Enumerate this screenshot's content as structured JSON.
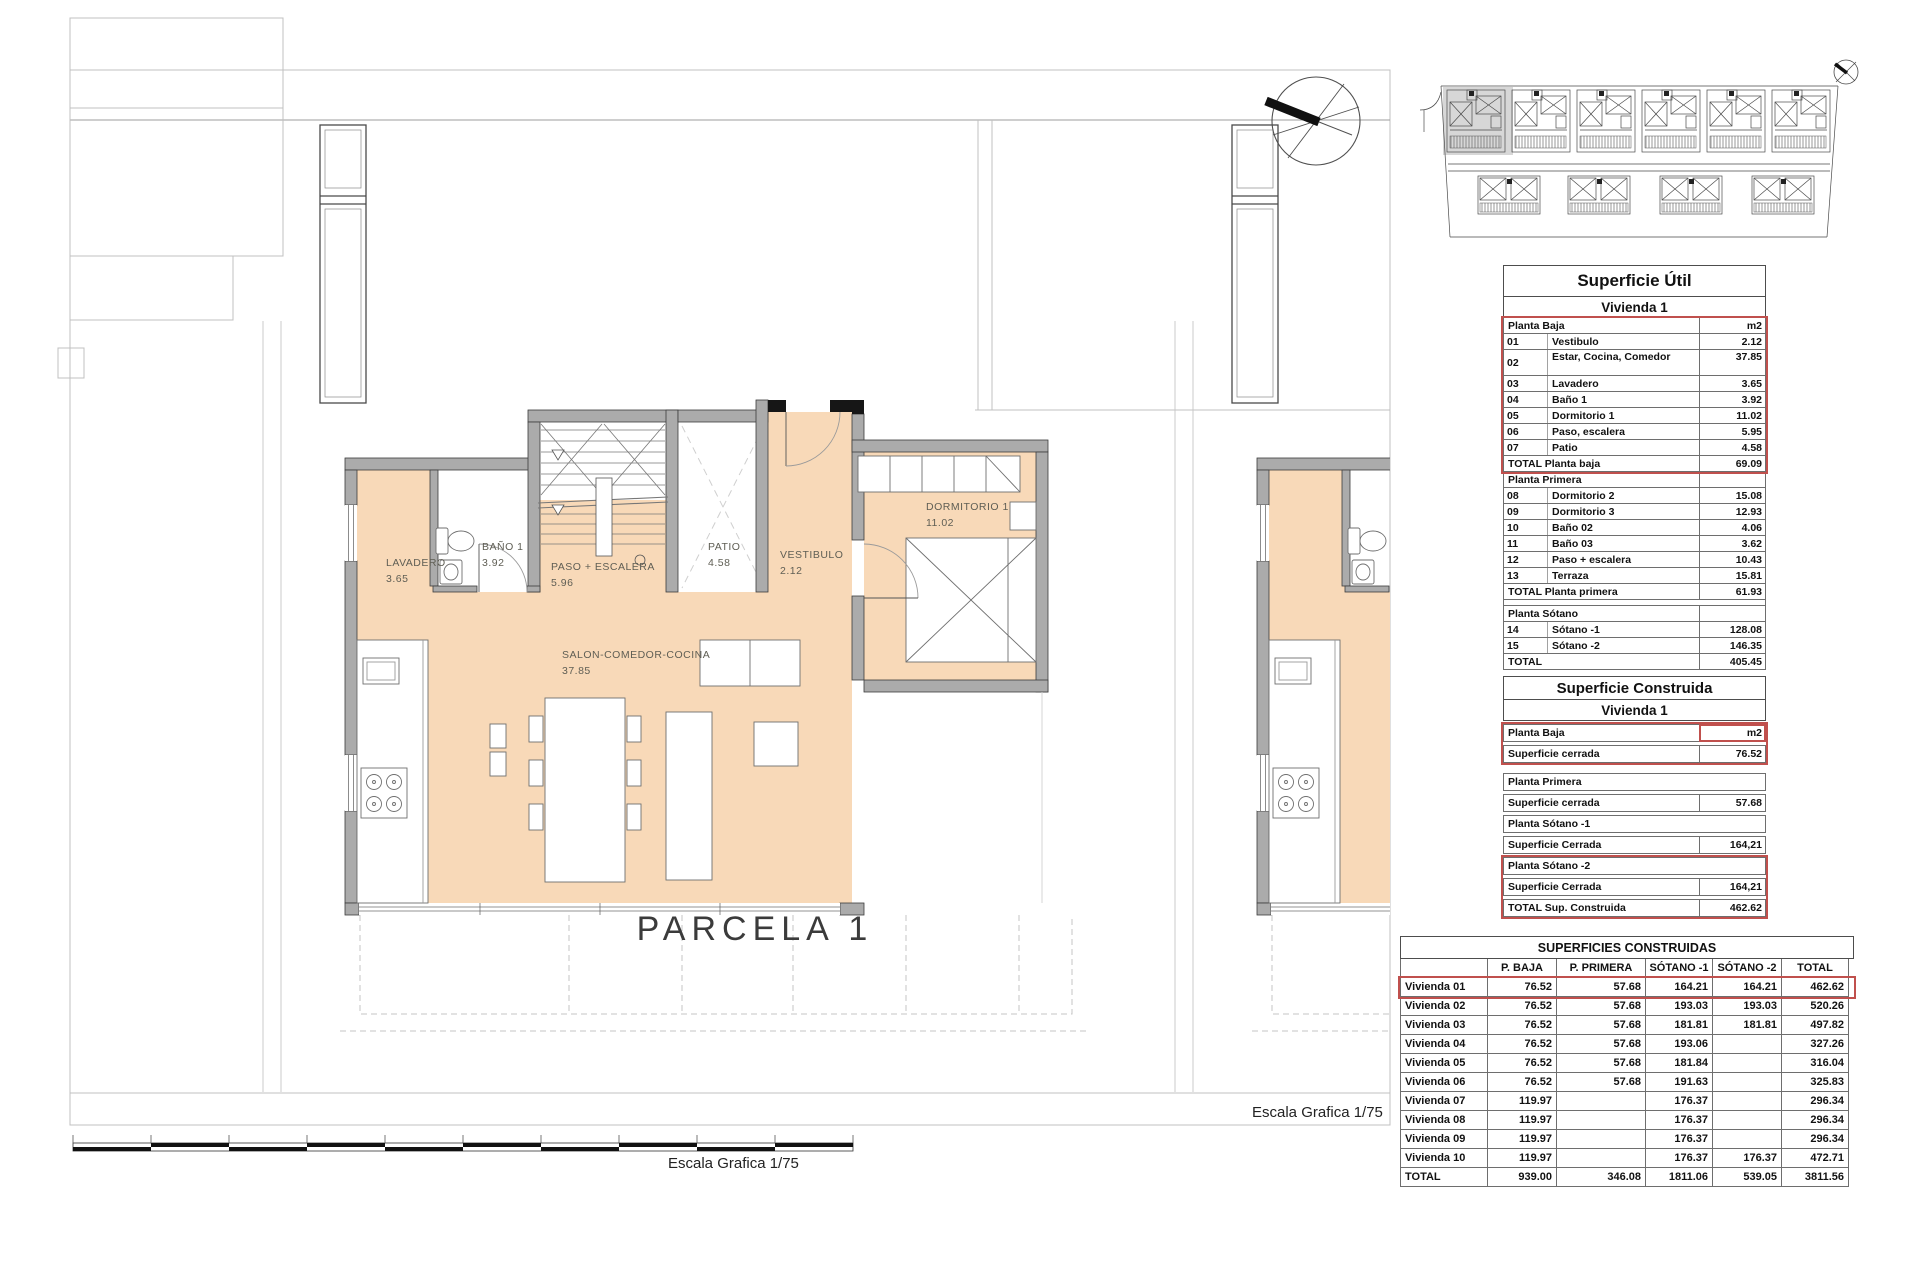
{
  "plan": {
    "parcel_label": "PARCELA 1",
    "scale_label_bottom": "Escala Grafica 1/75",
    "scale_label_right": "Escala Grafica 1/75",
    "rooms": [
      {
        "name": "LAVADERO",
        "area": "3.65"
      },
      {
        "name": "BAÑO 1",
        "area": "3.92"
      },
      {
        "name": "PASO + ESCALERA",
        "area": "5.96"
      },
      {
        "name": "PATIO",
        "area": "4.58"
      },
      {
        "name": "VESTIBULO",
        "area": "2.12"
      },
      {
        "name": "DORMITORIO 1",
        "area": "11.02"
      },
      {
        "name": "SALON-COMEDOR-COCINA",
        "area": "37.85"
      }
    ]
  },
  "colors": {
    "room_fill": "#f8d9b8",
    "wall_fill": "#ababab",
    "red_accent": "#c0504d",
    "context_line": "#c0c0c0"
  },
  "tables": {
    "superficie_util": {
      "title": "Superficie Útil",
      "subtitle": "Vivienda 1",
      "rows": [
        {
          "type": "section",
          "label": "Planta Baja",
          "value": "m2",
          "red": "start"
        },
        {
          "type": "item",
          "num": "01",
          "label": "Vestibulo",
          "value": "2.12",
          "red": "mid"
        },
        {
          "type": "item",
          "num": "02",
          "label": "Estar, Cocina, Comedor",
          "value": "37.85",
          "red": "mid",
          "tall": true
        },
        {
          "type": "item",
          "num": "03",
          "label": "Lavadero",
          "value": "3.65",
          "red": "mid"
        },
        {
          "type": "item",
          "num": "04",
          "label": "Baño 1",
          "value": "3.92",
          "red": "mid"
        },
        {
          "type": "item",
          "num": "05",
          "label": "Dormitorio 1",
          "value": "11.02",
          "red": "mid"
        },
        {
          "type": "item",
          "num": "06",
          "label": "Paso, escalera",
          "value": "5.95",
          "red": "mid"
        },
        {
          "type": "item",
          "num": "07",
          "label": "Patio",
          "value": "4.58",
          "red": "mid"
        },
        {
          "type": "total",
          "label": "TOTAL Planta baja",
          "value": "69.09",
          "red": "end"
        },
        {
          "type": "section",
          "label": "Planta Primera",
          "value": ""
        },
        {
          "type": "item",
          "num": "08",
          "label": "Dormitorio 2",
          "value": "15.08"
        },
        {
          "type": "item",
          "num": "09",
          "label": "Dormitorio 3",
          "value": "12.93"
        },
        {
          "type": "item",
          "num": "10",
          "label": "Baño 02",
          "value": "4.06"
        },
        {
          "type": "item",
          "num": "11",
          "label": "Baño 03",
          "value": "3.62"
        },
        {
          "type": "item",
          "num": "12",
          "label": "Paso + escalera",
          "value": "10.43"
        },
        {
          "type": "item",
          "num": "13",
          "label": "Terraza",
          "value": "15.81"
        },
        {
          "type": "total",
          "label": "TOTAL Planta primera",
          "value": "61.93"
        },
        {
          "type": "spacer",
          "label": "",
          "value": ""
        },
        {
          "type": "section",
          "label": "Planta Sótano",
          "value": ""
        },
        {
          "type": "item",
          "num": "14",
          "label": "Sótano -1",
          "value": "128.08"
        },
        {
          "type": "item",
          "num": "15",
          "label": "Sótano -2",
          "value": "146.35"
        },
        {
          "type": "total",
          "label": "TOTAL",
          "value": "405.45"
        }
      ]
    },
    "superficie_construida": {
      "title": "Superficie Construida",
      "subtitle": "Vivienda 1",
      "rows": [
        {
          "style": "section",
          "label": "Planta Baja",
          "value": "m2",
          "red": "start",
          "red_value": true
        },
        {
          "style": "value",
          "label": "Superficie cerrada",
          "value": "76.52",
          "red": "end"
        },
        {
          "style": "section",
          "label": "Planta Primera",
          "value": "",
          "gap": true
        },
        {
          "style": "value",
          "label": "Superficie cerrada",
          "value": "57.68"
        },
        {
          "style": "section",
          "label": "Planta Sótano -1",
          "value": ""
        },
        {
          "style": "value",
          "label": "Superficie Cerrada",
          "value": "164,21"
        },
        {
          "style": "section",
          "label": "Planta Sótano -2",
          "value": "",
          "red": "start"
        },
        {
          "style": "value",
          "label": "Superficie Cerrada",
          "value": "164,21",
          "red": "mid"
        },
        {
          "style": "total",
          "label": "TOTAL Sup. Construida",
          "value": "462.62",
          "red": "end"
        }
      ]
    },
    "superficies_construidas": {
      "title": "SUPERFICIES CONSTRUIDAS",
      "columns": [
        "",
        "P. BAJA",
        "P. PRIMERA",
        "SÓTANO -1",
        "SÓTANO -2",
        "TOTAL"
      ],
      "rows": [
        {
          "label": "Vivienda 01",
          "values": [
            "76.52",
            "57.68",
            "164.21",
            "164.21",
            "462.62"
          ],
          "red": true
        },
        {
          "label": "Vivienda 02",
          "values": [
            "76.52",
            "57.68",
            "193.03",
            "193.03",
            "520.26"
          ]
        },
        {
          "label": "Vivienda 03",
          "values": [
            "76.52",
            "57.68",
            "181.81",
            "181.81",
            "497.82"
          ]
        },
        {
          "label": "Vivienda 04",
          "values": [
            "76.52",
            "57.68",
            "193.06",
            "",
            "327.26"
          ]
        },
        {
          "label": "Vivienda 05",
          "values": [
            "76.52",
            "57.68",
            "181.84",
            "",
            "316.04"
          ]
        },
        {
          "label": "Vivienda 06",
          "values": [
            "76.52",
            "57.68",
            "191.63",
            "",
            "325.83"
          ]
        },
        {
          "label": "Vivienda 07",
          "values": [
            "119.97",
            "",
            "176.37",
            "",
            "296.34"
          ]
        },
        {
          "label": "Vivienda 08",
          "values": [
            "119.97",
            "",
            "176.37",
            "",
            "296.34"
          ]
        },
        {
          "label": "Vivienda 09",
          "values": [
            "119.97",
            "",
            "176.37",
            "",
            "296.34"
          ]
        },
        {
          "label": "Vivienda 10",
          "values": [
            "119.97",
            "",
            "176.37",
            "176.37",
            "472.71"
          ]
        },
        {
          "label": "TOTAL",
          "values": [
            "939.00",
            "346.08",
            "1811.06",
            "539.05",
            "3811.56"
          ],
          "total": true
        }
      ]
    }
  }
}
